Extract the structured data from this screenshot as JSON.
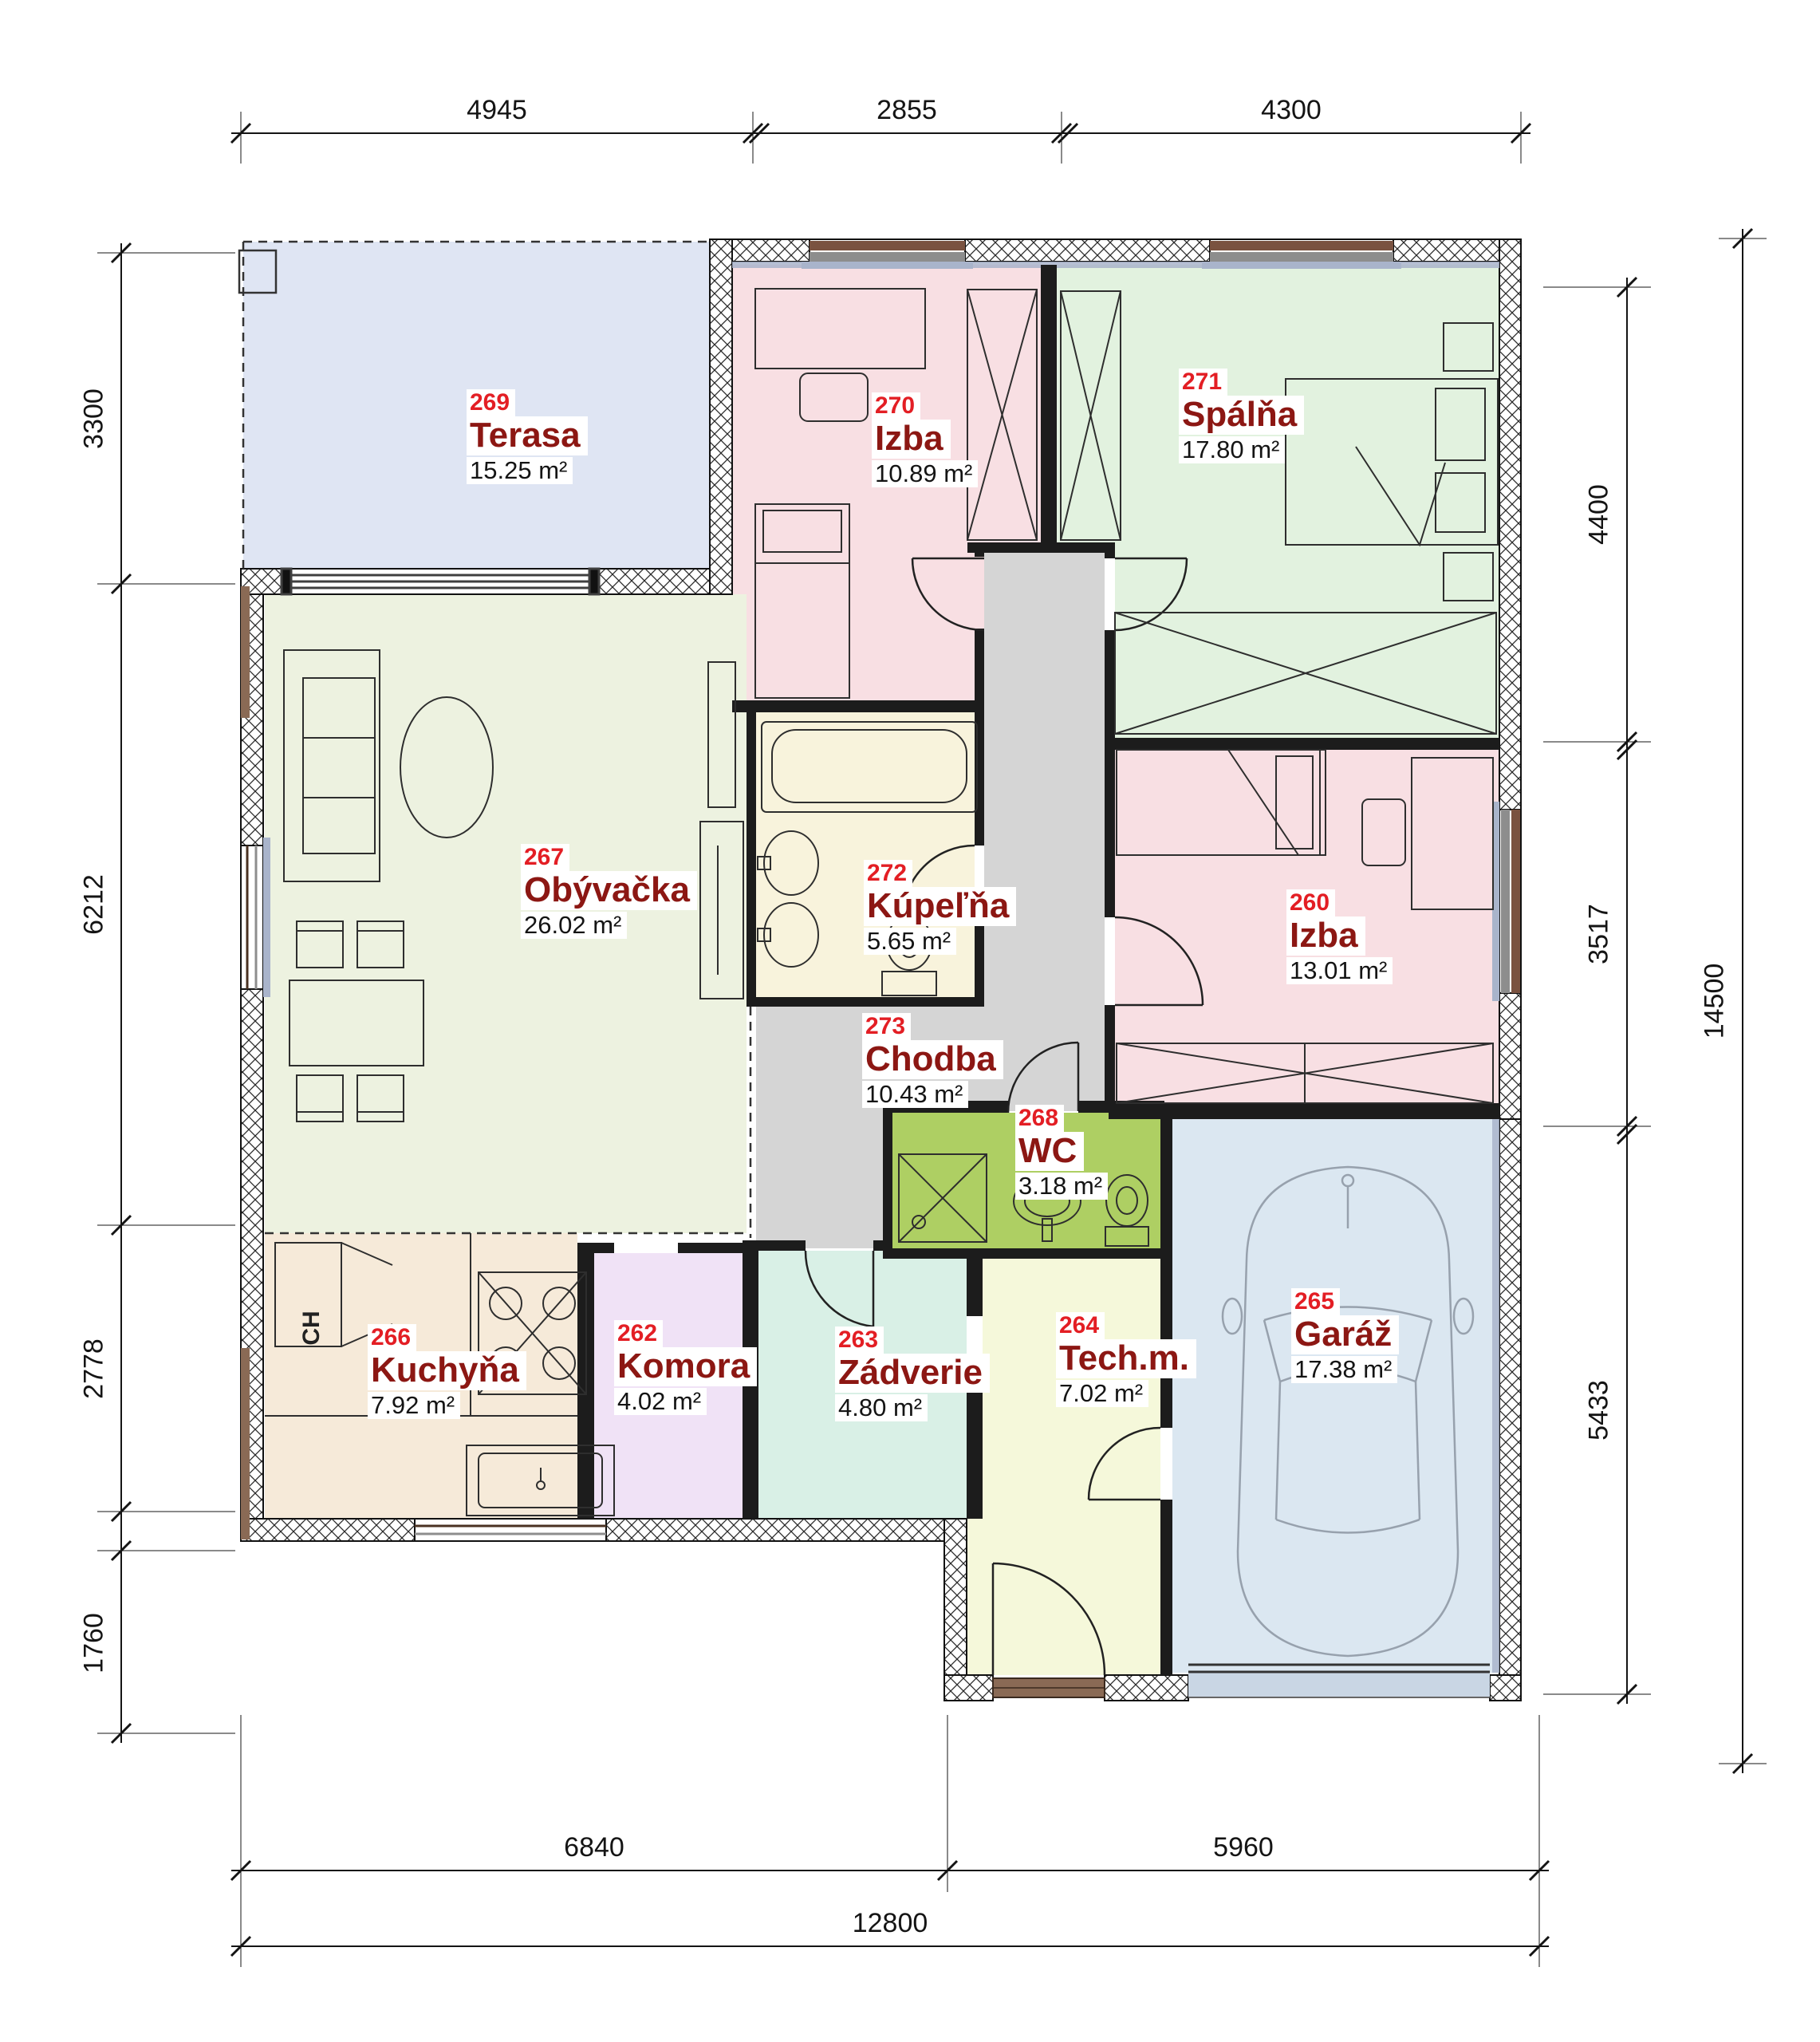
{
  "plan": {
    "title": "Floor plan - ground floor",
    "rooms": [
      {
        "number": "269",
        "name": "Terasa",
        "area": "15.25 m²"
      },
      {
        "number": "270",
        "name": "Izba",
        "area": "10.89 m²"
      },
      {
        "number": "271",
        "name": "Spálňa",
        "area": "17.80 m²"
      },
      {
        "number": "267",
        "name": "Obývačka",
        "area": "26.02 m²"
      },
      {
        "number": "272",
        "name": "Kúpeľňa",
        "area": "5.65 m²"
      },
      {
        "number": "273",
        "name": "Chodba",
        "area": "10.43 m²"
      },
      {
        "number": "260",
        "name": "Izba",
        "area": "13.01 m²"
      },
      {
        "number": "268",
        "name": "WC",
        "area": "3.18 m²"
      },
      {
        "number": "266",
        "name": "Kuchyňa",
        "area": "7.92 m²"
      },
      {
        "number": "262",
        "name": "Komora",
        "area": "4.02 m²"
      },
      {
        "number": "263",
        "name": "Zádverie",
        "area": "4.80 m²"
      },
      {
        "number": "264",
        "name": "Tech.m.",
        "area": "7.02 m²"
      },
      {
        "number": "265",
        "name": "Garáž",
        "area": "17.38 m²"
      }
    ],
    "kitchen_appliance_label": "CH",
    "dimensions": {
      "top": [
        "4945",
        "2855",
        "4300"
      ],
      "left": [
        "3300",
        "6212",
        "2778",
        "1760"
      ],
      "right": [
        "4400",
        "3517",
        "5433"
      ],
      "right_total": "14500",
      "bottom": [
        "6840",
        "5960"
      ],
      "bottom_total": "12800"
    },
    "palette": {
      "terasa": "#dfe5f3",
      "izba": "#f8dfe3",
      "spalna": "#e2f2df",
      "obyvacka": "#edf2e0",
      "kupelna": "#f8f3dc",
      "chodba": "#d5d5d5",
      "wc": "#aecf63",
      "kuchyna": "#f6ead9",
      "komora": "#f0e2f6",
      "zadverie": "#d9f0e6",
      "techm": "#f5f8da",
      "garaz": "#dbe7f1",
      "number_red": "#e31e24",
      "name_red": "#8c1713",
      "wall": "#1c1c1c",
      "sill_blue": "#a9b4cb",
      "wood_brown": "#8a6a55",
      "car_gray": "#97a1ad"
    }
  }
}
